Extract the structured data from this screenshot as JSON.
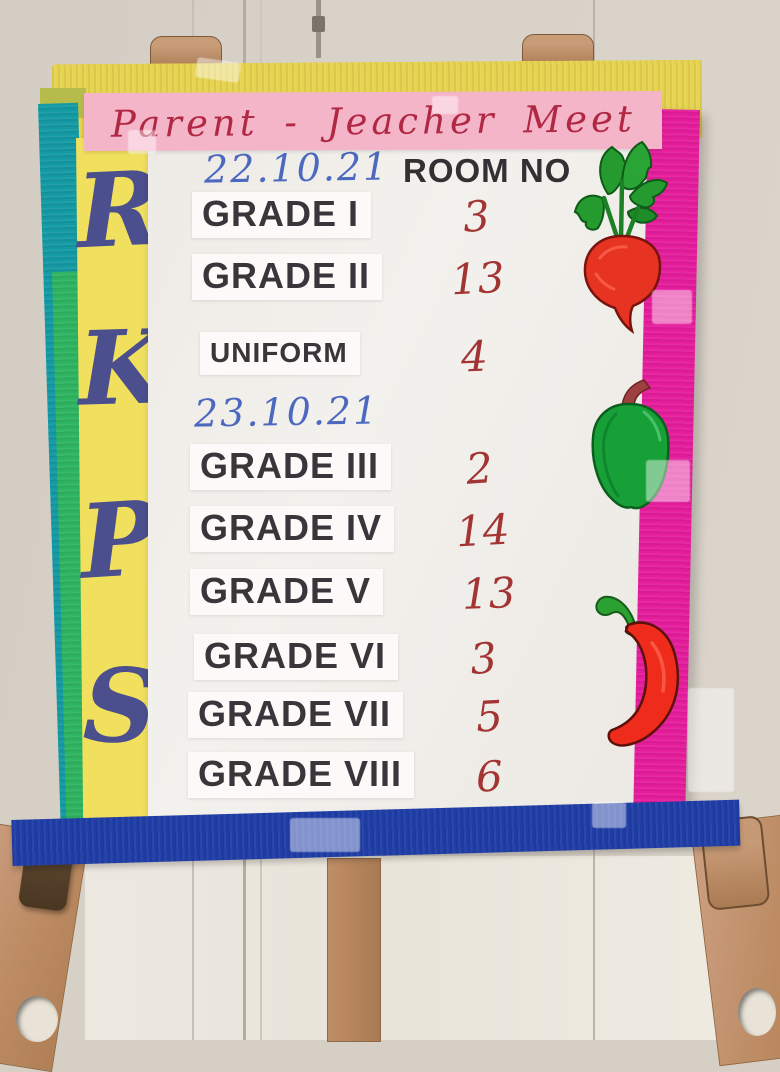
{
  "banner": {
    "title": "Parent - Jeacher Meet"
  },
  "initials": {
    "letters": [
      "R",
      "K",
      "P",
      "S"
    ]
  },
  "schedule": {
    "date1": "22.10.21",
    "room_header": "ROOM NO",
    "date2": "23.10.21",
    "entries": [
      {
        "grade": "GRADE I",
        "room": "3"
      },
      {
        "grade": "GRADE II",
        "room": "13"
      },
      {
        "grade": "UNIFORM",
        "room": "4"
      },
      {
        "grade": "GRADE III",
        "room": "2"
      },
      {
        "grade": "GRADE IV",
        "room": "14"
      },
      {
        "grade": "GRADE V",
        "room": "13"
      },
      {
        "grade": "GRADE VI",
        "room": "3"
      },
      {
        "grade": "GRADE VII",
        "room": "5"
      },
      {
        "grade": "GRADE VIII",
        "room": "6"
      }
    ]
  },
  "decorations": {
    "icons": [
      "radish-icon",
      "capsicum-icon",
      "chili-icon"
    ]
  },
  "colors": {
    "banner_pink": "#f5b5c8",
    "title_red": "#b02844",
    "top_yellow": "#e6d34f",
    "side_yellow": "#f1e05e",
    "teal": "#149aa4",
    "green": "#2eb461",
    "magenta": "#e51d9c",
    "blue": "#1f3da6",
    "initials_ink": "#4c4f8d",
    "date_ink": "#4d69bf",
    "grade_ink": "#3a353b",
    "room_ink": "#a33434",
    "paper": "#f0ede9",
    "wall": "#d6cfc5",
    "wood": "#bd8c64"
  }
}
